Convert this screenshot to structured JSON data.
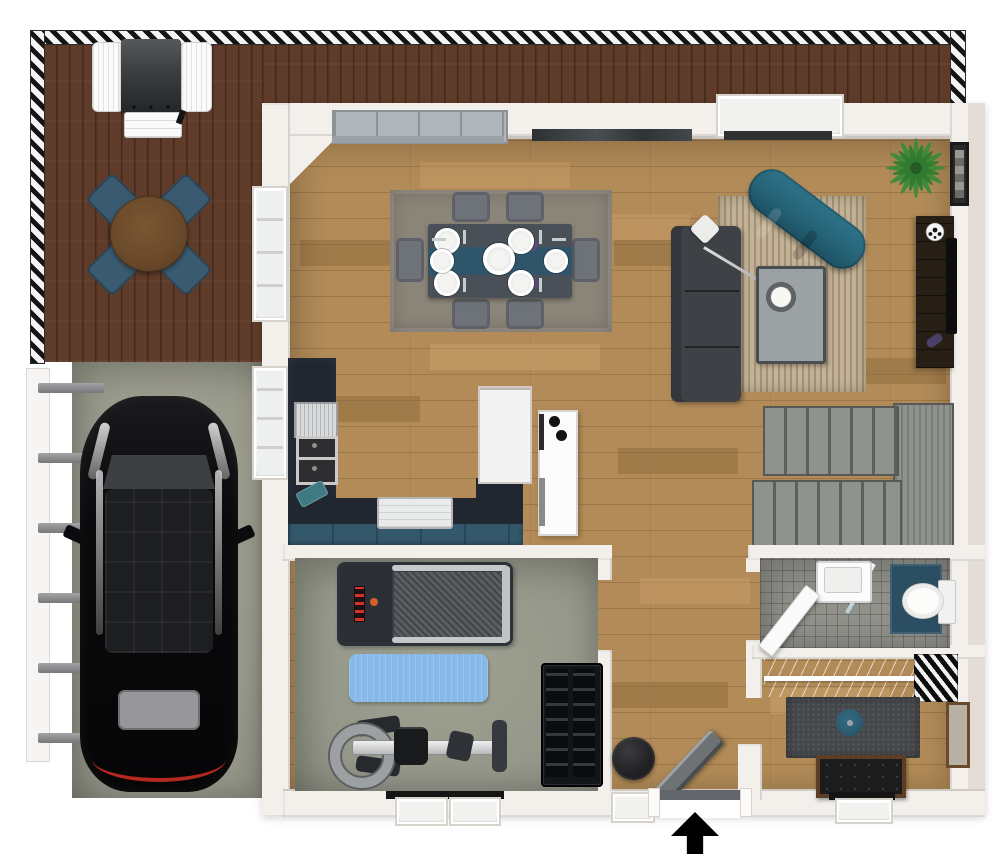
{
  "palette": {
    "wall": "#f3f0ec",
    "deck_wood": "#5f3b29",
    "garage_floor": "#999a8c",
    "gym_floor": "#95978a",
    "wood_base": "#b28b58",
    "tile_floor": "#90918b",
    "outdoor_chair": "#3a5a70",
    "outdoor_table": "#6b4a2a",
    "kitchen_counter": "#212730",
    "cabinet_navy": "#33576b",
    "dining_chair": "#6e737a",
    "dining_table": "#4a5057",
    "table_runner": "#2e556a",
    "rug_dining": "#8b8478",
    "rug_living": "#c3b296",
    "sofa": "#3e4246",
    "chaise_teal": "#266478",
    "coffee_table": "#9ca2a4",
    "tv_console": "#271e15",
    "stairs_tread": "#8f928f",
    "mat_blue": "#86b8ea",
    "shower_navy": "#2c4e63",
    "rug_closet": "#45484b",
    "cushion_teal": "#2b5c72",
    "leather_black": "#1c1c1d",
    "bench_wood": "#5d3e24",
    "car_black": "#0b0b0d",
    "plant_green": "#3d8a3b",
    "arrow_black": "#000000"
  },
  "legend": {
    "entrance_arrow_glyph": "▲"
  },
  "rooms": [
    {
      "id": "deck",
      "items": [
        "bbq-grill",
        "outdoor-dining-table",
        "outdoor-chair x4",
        "railing"
      ]
    },
    {
      "id": "garage",
      "items": [
        "car",
        "side-fence"
      ]
    },
    {
      "id": "kitchen",
      "items": [
        "range",
        "double-sink",
        "cutting-board",
        "base-cabinets",
        "counter-tray",
        "refrigerator",
        "island-cooktop"
      ]
    },
    {
      "id": "dining-area",
      "items": [
        "area-rug",
        "dining-table",
        "table-runner",
        "dining-chair x6",
        "place-setting x6",
        "centerpiece"
      ]
    },
    {
      "id": "living-area",
      "items": [
        "striped-rug",
        "sofa",
        "throw-pillow",
        "arc-floor-lamp",
        "chaise-lounge",
        "coffee-table",
        "media-console",
        "tv",
        "soccer-ball",
        "game-controller",
        "potted-plant",
        "wall-art"
      ]
    },
    {
      "id": "stairs",
      "items": [
        "upper-flight",
        "landing",
        "lower-flight"
      ]
    },
    {
      "id": "gym",
      "items": [
        "treadmill",
        "yoga-mat",
        "rowing-machine",
        "dumbbell-rack",
        "window x2"
      ]
    },
    {
      "id": "hallway",
      "items": [
        "floor-pouf",
        "entry-bench",
        "entry-door",
        "window",
        "entrance-arrow"
      ]
    },
    {
      "id": "bathroom",
      "items": [
        "door",
        "vanity-sink",
        "glass-screen",
        "shower",
        "toilet"
      ]
    },
    {
      "id": "closet-room",
      "items": [
        "wire-closet-shelf",
        "hanging-clothes",
        "area-rug",
        "floor-cushion",
        "leather-bench",
        "wall-mirror",
        "window"
      ]
    }
  ]
}
